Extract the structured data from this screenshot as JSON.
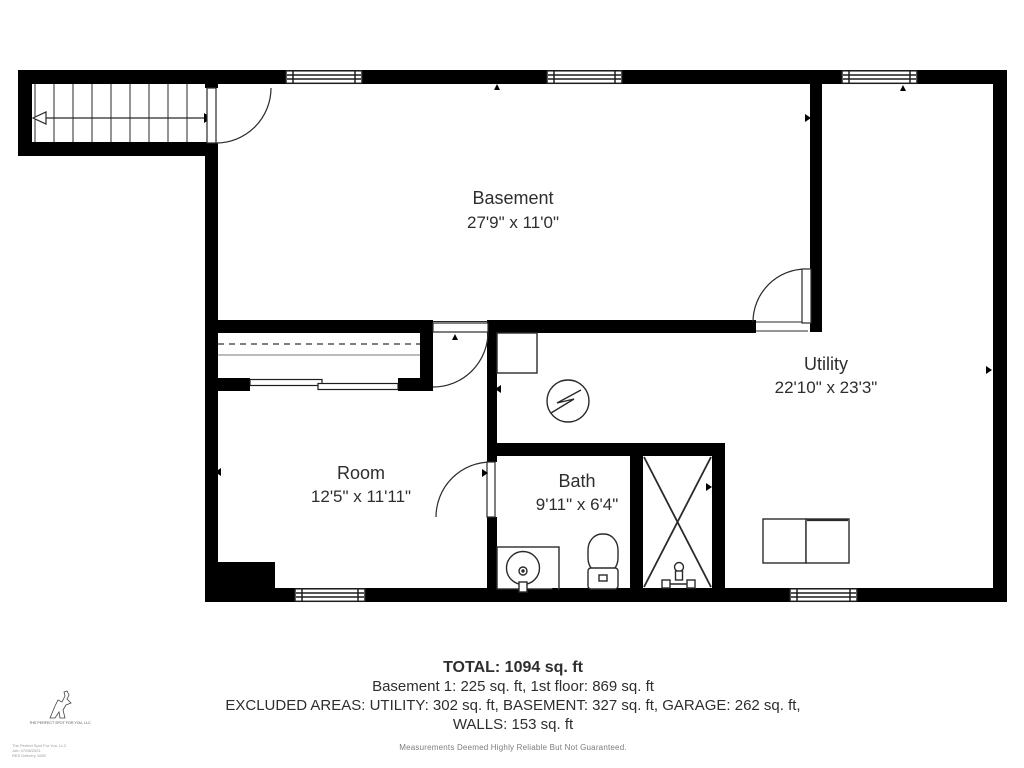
{
  "rooms": {
    "basement": {
      "name": "Basement",
      "dims": "27'9\" x 11'0\""
    },
    "utility": {
      "name": "Utility",
      "dims": "22'10\" x 23'3\""
    },
    "room": {
      "name": "Room",
      "dims": "12'5\" x 11'11\""
    },
    "bath": {
      "name": "Bath",
      "dims": "9'11\" x 6'4\""
    }
  },
  "summary": {
    "total": "TOTAL: 1094 sq. ft",
    "floors": "Basement 1: 225 sq. ft, 1st floor: 869 sq. ft",
    "excluded": "EXCLUDED AREAS: UTILITY: 302 sq. ft, BASEMENT: 327 sq. ft, GARAGE: 262 sq. ft,",
    "walls": "WALLS: 153 sq. ft",
    "disclaimer": "Measurements Deemed Highly Reliable But Not Guaranteed."
  },
  "branding": {
    "logo_caption": "THE PERFECT SPOT FOR YOU, LLC",
    "fine_print": [
      "The Perfect Spot For You, LLC",
      "Job: 07/08/2021",
      "RES Delivery 1080"
    ]
  },
  "colors": {
    "wall": "#000000",
    "line": "#2a2a2a",
    "text": "#2e2e2e",
    "muted": "#8a8a8a"
  }
}
